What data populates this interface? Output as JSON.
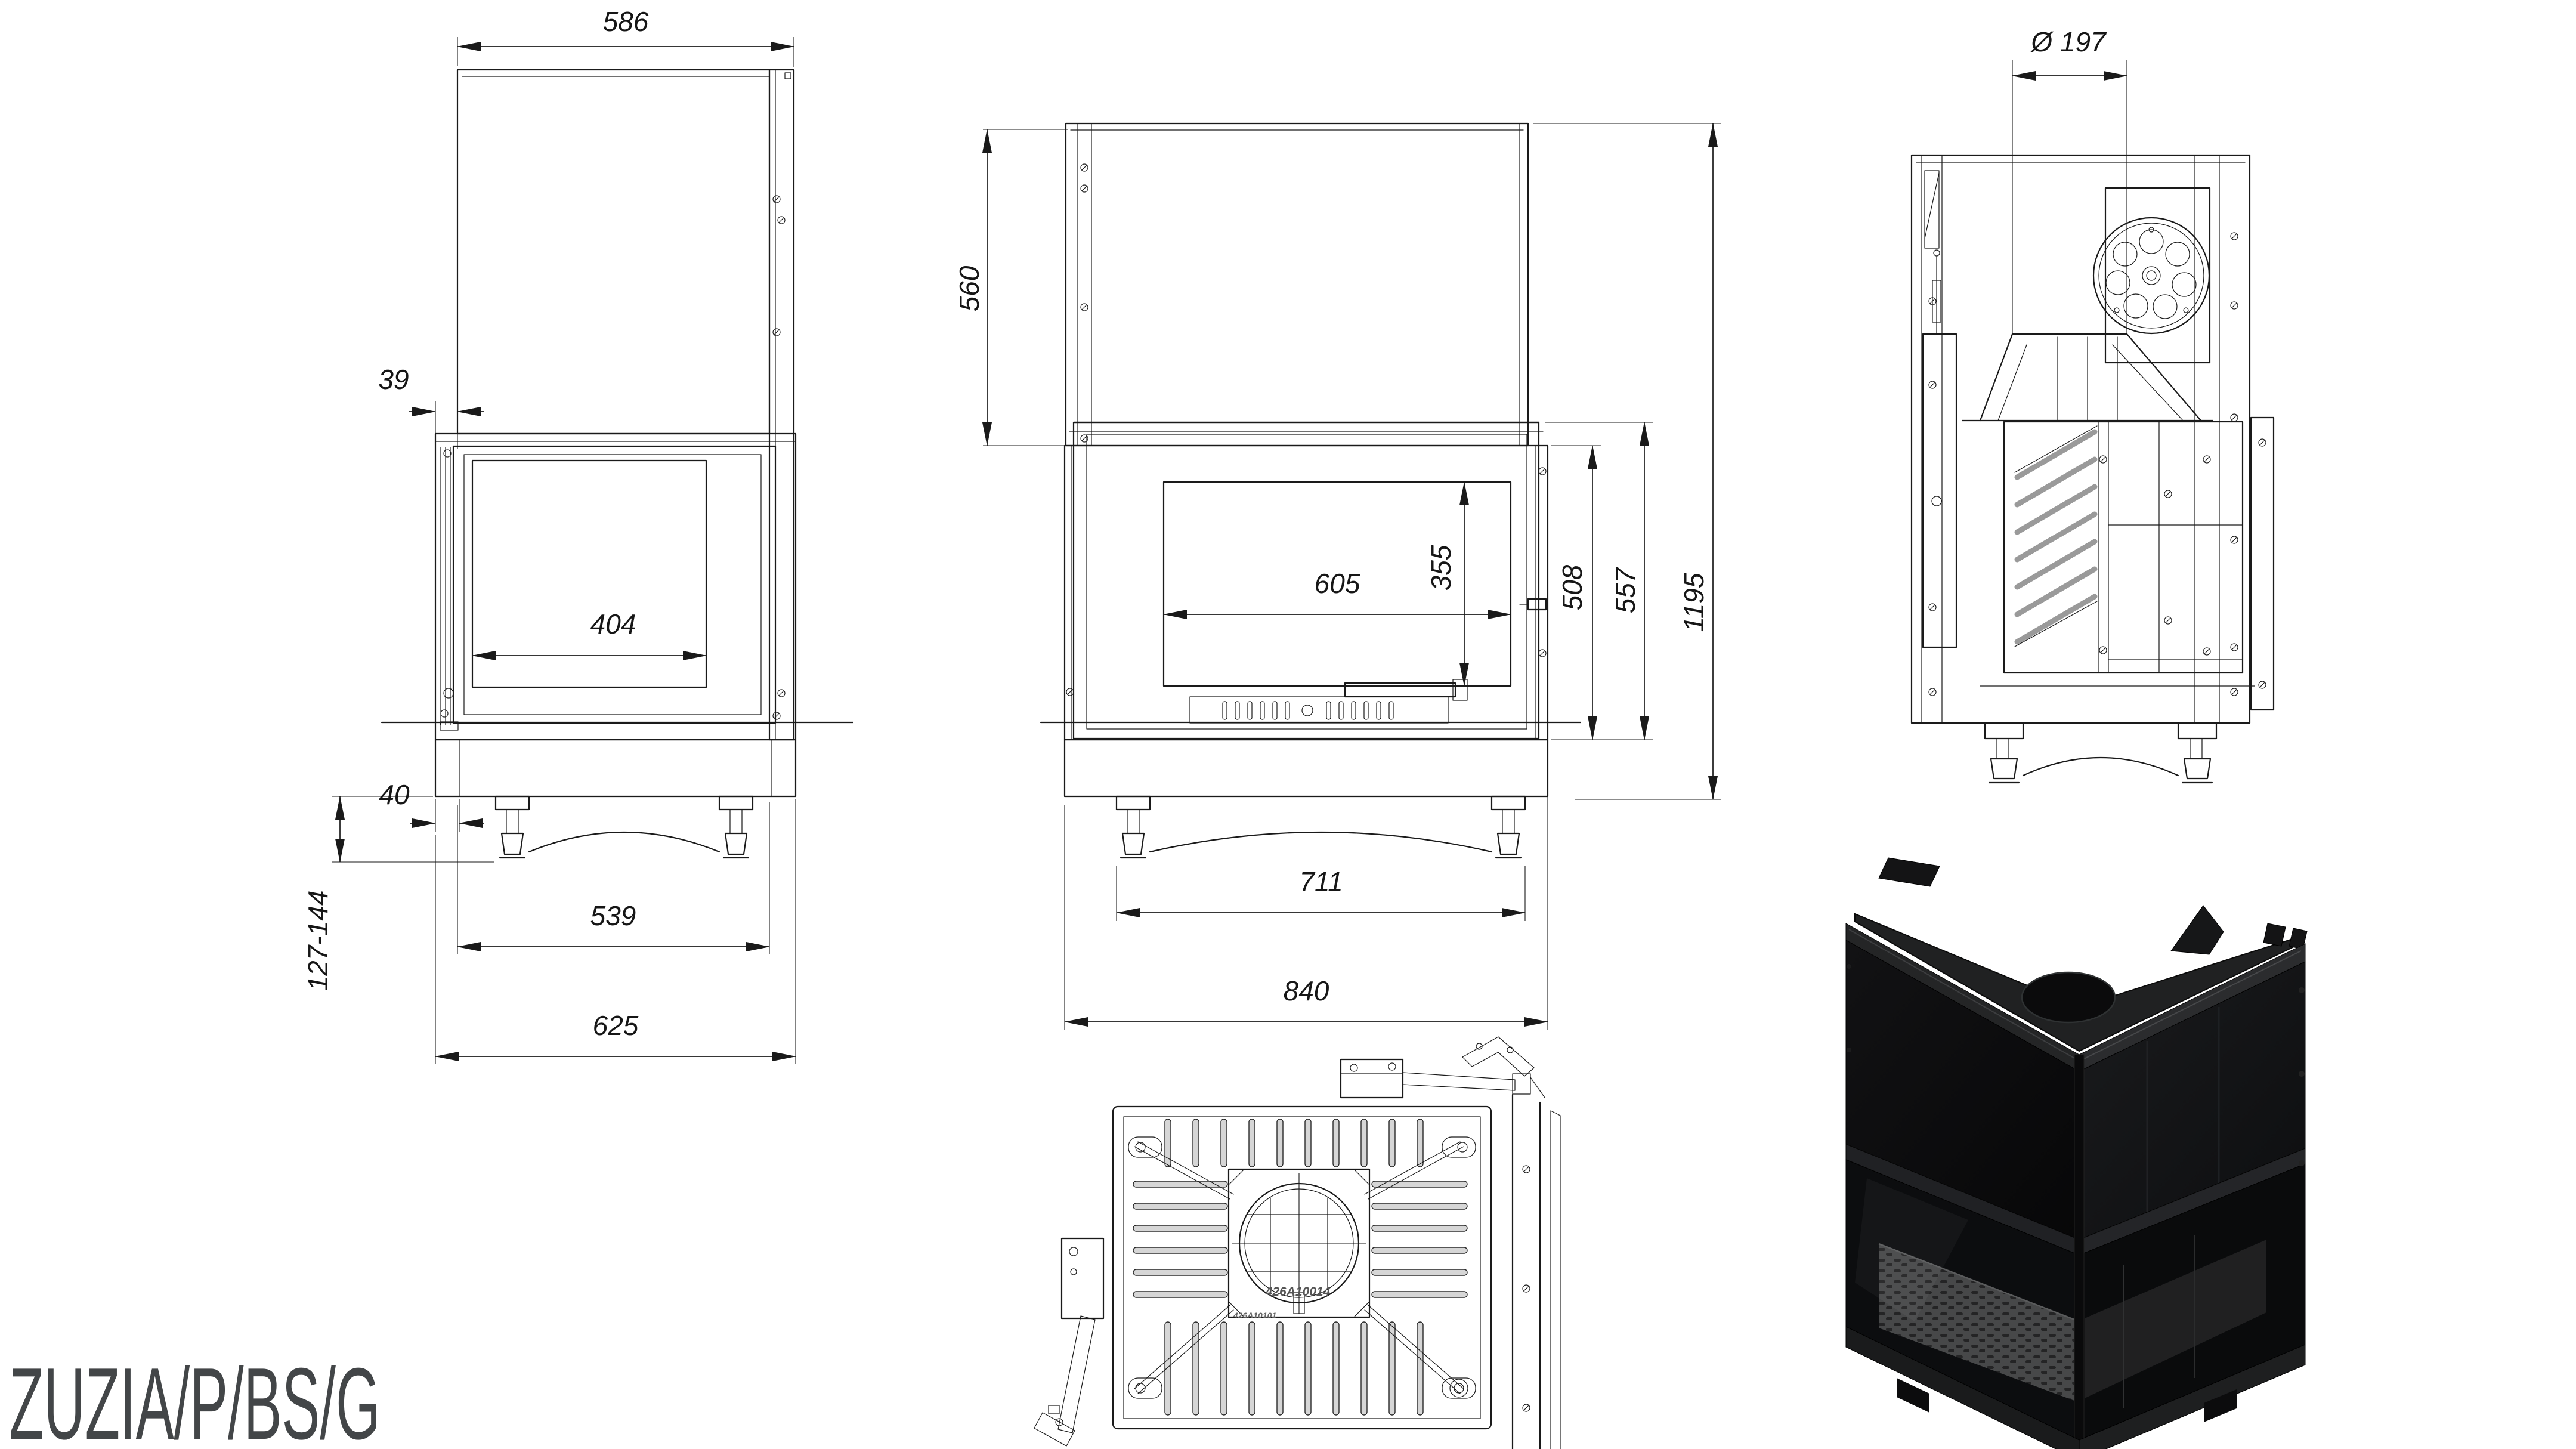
{
  "product_code": "ZUZIA/P/BS/G",
  "colors": {
    "line": "#1a1a1a",
    "background": "#ffffff",
    "render_body": "#0e0f10",
    "label_text": "#434648"
  },
  "views": {
    "side": {
      "title": "side-view",
      "dims": {
        "depth_top": "586",
        "front_offset_top": "39",
        "glass_width": "404",
        "front_offset_bottom": "40",
        "feet_adjust": "127-144",
        "body_depth": "539",
        "total_depth": "625"
      }
    },
    "front": {
      "title": "front-view",
      "dims": {
        "chamber_height": "560",
        "glass_width": "605",
        "glass_height": "355",
        "firebox_height": "508",
        "door_height": "557",
        "total_height": "1195",
        "feet_span": "711",
        "total_width": "840"
      }
    },
    "rear": {
      "title": "rear-view",
      "dims": {
        "flue_diameter": "Ø 197"
      }
    },
    "top": {
      "title": "top-view",
      "part_numbers": {
        "primary": "426A10014",
        "secondary": "426A10101"
      }
    }
  }
}
